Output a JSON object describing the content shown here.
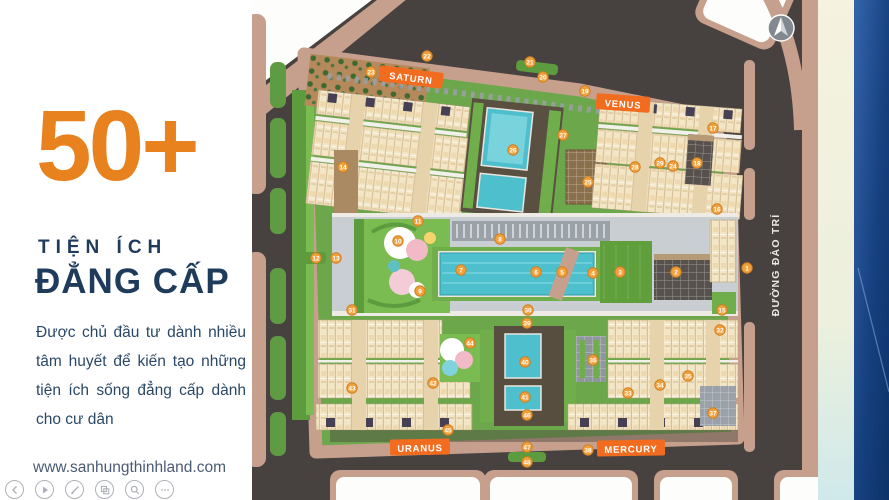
{
  "panel": {
    "stat": "50+",
    "title_line1": "TIỆN ÍCH",
    "title_line2": "ĐẲNG CẤP",
    "description": "Được chủ đầu tư dành nhiều tâm huyết để kiến tạo những tiện ích sống đẳng cấp dành cho cư dân",
    "website": "www.sanhungthinhland.com",
    "accent_color": "#E8821F",
    "navy_color": "#1E3B5C"
  },
  "viewer_controls": [
    "previous",
    "play",
    "edit",
    "copy",
    "zoom",
    "more"
  ],
  "map": {
    "zones": [
      {
        "name": "SATURN"
      },
      {
        "name": "VENUS"
      },
      {
        "name": "URANUS"
      },
      {
        "name": "MERCURY"
      }
    ],
    "road_label": "ĐƯỜNG ĐÀO TRÍ",
    "compass": "north-arrow",
    "colors": {
      "zone_label": "#F26C1F",
      "marker": "#F1A13B",
      "road": "#474140",
      "sidewalk": "#C7A08D",
      "greenery": "#6DA74B",
      "pool": "#4EBFCC"
    },
    "markers": [
      {
        "label": "1",
        "x": 747,
        "y": 268
      },
      {
        "label": "2",
        "x": 676,
        "y": 272
      },
      {
        "label": "3",
        "x": 620,
        "y": 272
      },
      {
        "label": "4",
        "x": 593,
        "y": 273
      },
      {
        "label": "5",
        "x": 562,
        "y": 272
      },
      {
        "label": "6",
        "x": 536,
        "y": 272
      },
      {
        "label": "7",
        "x": 461,
        "y": 270
      },
      {
        "label": "8",
        "x": 500,
        "y": 239
      },
      {
        "label": "9",
        "x": 420,
        "y": 291
      },
      {
        "label": "10",
        "x": 398,
        "y": 241
      },
      {
        "label": "11",
        "x": 418,
        "y": 221
      },
      {
        "label": "12",
        "x": 316,
        "y": 258
      },
      {
        "label": "13",
        "x": 336,
        "y": 258
      },
      {
        "label": "14",
        "x": 343,
        "y": 167
      },
      {
        "label": "15",
        "x": 722,
        "y": 310
      },
      {
        "label": "16",
        "x": 717,
        "y": 209
      },
      {
        "label": "17",
        "x": 713,
        "y": 128
      },
      {
        "label": "18",
        "x": 697,
        "y": 163
      },
      {
        "label": "19",
        "x": 585,
        "y": 91
      },
      {
        "label": "20",
        "x": 543,
        "y": 77
      },
      {
        "label": "21",
        "x": 530,
        "y": 62
      },
      {
        "label": "22",
        "x": 427,
        "y": 56
      },
      {
        "label": "23",
        "x": 371,
        "y": 72
      },
      {
        "label": "24",
        "x": 673,
        "y": 166
      },
      {
        "label": "25",
        "x": 588,
        "y": 182
      },
      {
        "label": "26",
        "x": 513,
        "y": 150
      },
      {
        "label": "27",
        "x": 563,
        "y": 135
      },
      {
        "label": "28",
        "x": 635,
        "y": 167
      },
      {
        "label": "29",
        "x": 660,
        "y": 163
      },
      {
        "label": "30",
        "x": 528,
        "y": 310
      },
      {
        "label": "31",
        "x": 352,
        "y": 310
      },
      {
        "label": "32",
        "x": 720,
        "y": 330
      },
      {
        "label": "33",
        "x": 628,
        "y": 393
      },
      {
        "label": "34",
        "x": 660,
        "y": 385
      },
      {
        "label": "35",
        "x": 688,
        "y": 376
      },
      {
        "label": "36",
        "x": 593,
        "y": 360
      },
      {
        "label": "37",
        "x": 713,
        "y": 413
      },
      {
        "label": "38",
        "x": 588,
        "y": 450
      },
      {
        "label": "39",
        "x": 527,
        "y": 323
      },
      {
        "label": "40",
        "x": 525,
        "y": 362
      },
      {
        "label": "41",
        "x": 525,
        "y": 397
      },
      {
        "label": "42",
        "x": 433,
        "y": 383
      },
      {
        "label": "43",
        "x": 352,
        "y": 388
      },
      {
        "label": "44",
        "x": 470,
        "y": 343
      },
      {
        "label": "45",
        "x": 448,
        "y": 430
      },
      {
        "label": "46",
        "x": 527,
        "y": 415
      },
      {
        "label": "47",
        "x": 527,
        "y": 447
      },
      {
        "label": "48",
        "x": 527,
        "y": 462
      }
    ]
  }
}
